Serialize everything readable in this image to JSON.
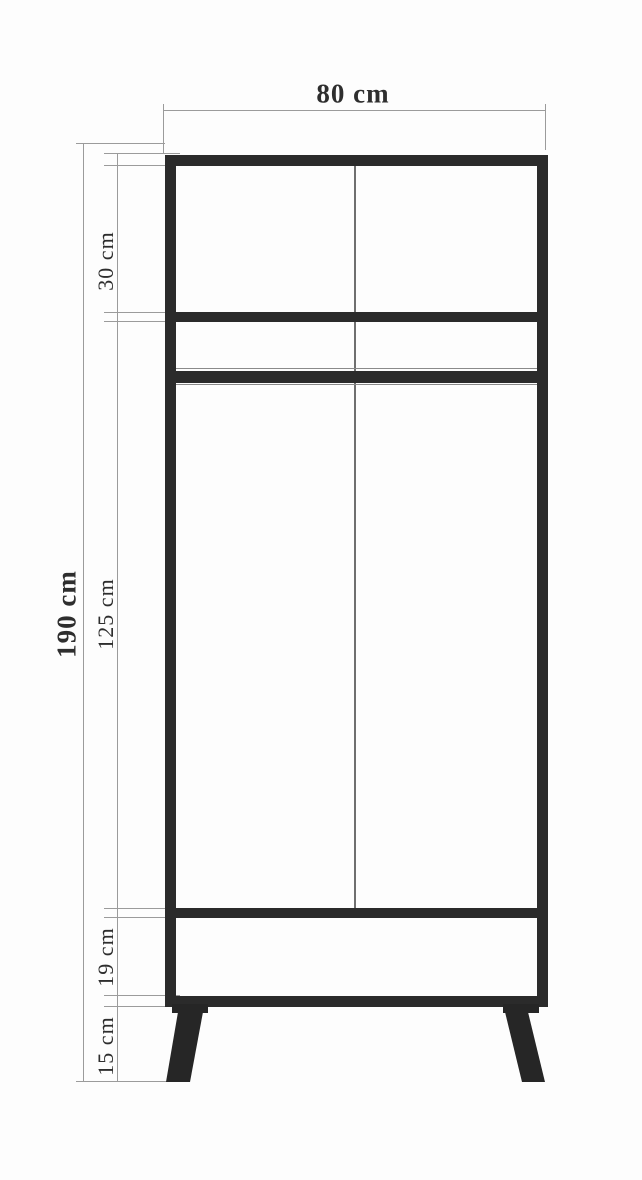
{
  "diagram": {
    "type": "furniture-dimension-drawing",
    "subject": "two-door wardrobe front elevation",
    "dimensions": {
      "width": {
        "label": "80 cm",
        "value_cm": 80,
        "orientation": "horizontal",
        "measures": "overall cabinet width"
      },
      "overall_height": {
        "label": "190 cm",
        "value_cm": 190,
        "orientation": "vertical",
        "measures": "overall height including legs"
      },
      "top_section": {
        "label": "30 cm",
        "value_cm": 30,
        "orientation": "vertical",
        "measures": "top shelf compartment height"
      },
      "middle_section": {
        "label": "125 cm",
        "value_cm": 125,
        "orientation": "vertical",
        "measures": "main hanging compartment height"
      },
      "bottom_section": {
        "label": "19 cm",
        "value_cm": 19,
        "orientation": "vertical",
        "measures": "bottom compartment height"
      },
      "legs": {
        "label": "15 cm",
        "value_cm": 15,
        "orientation": "vertical",
        "measures": "leg height"
      }
    },
    "colors": {
      "structure_line": "#2b2b2b",
      "dimension_line": "#9b9b9b",
      "divider_line": "#6f6f6f",
      "text": "#2e2e2e",
      "background": "#fdfdfd"
    }
  }
}
